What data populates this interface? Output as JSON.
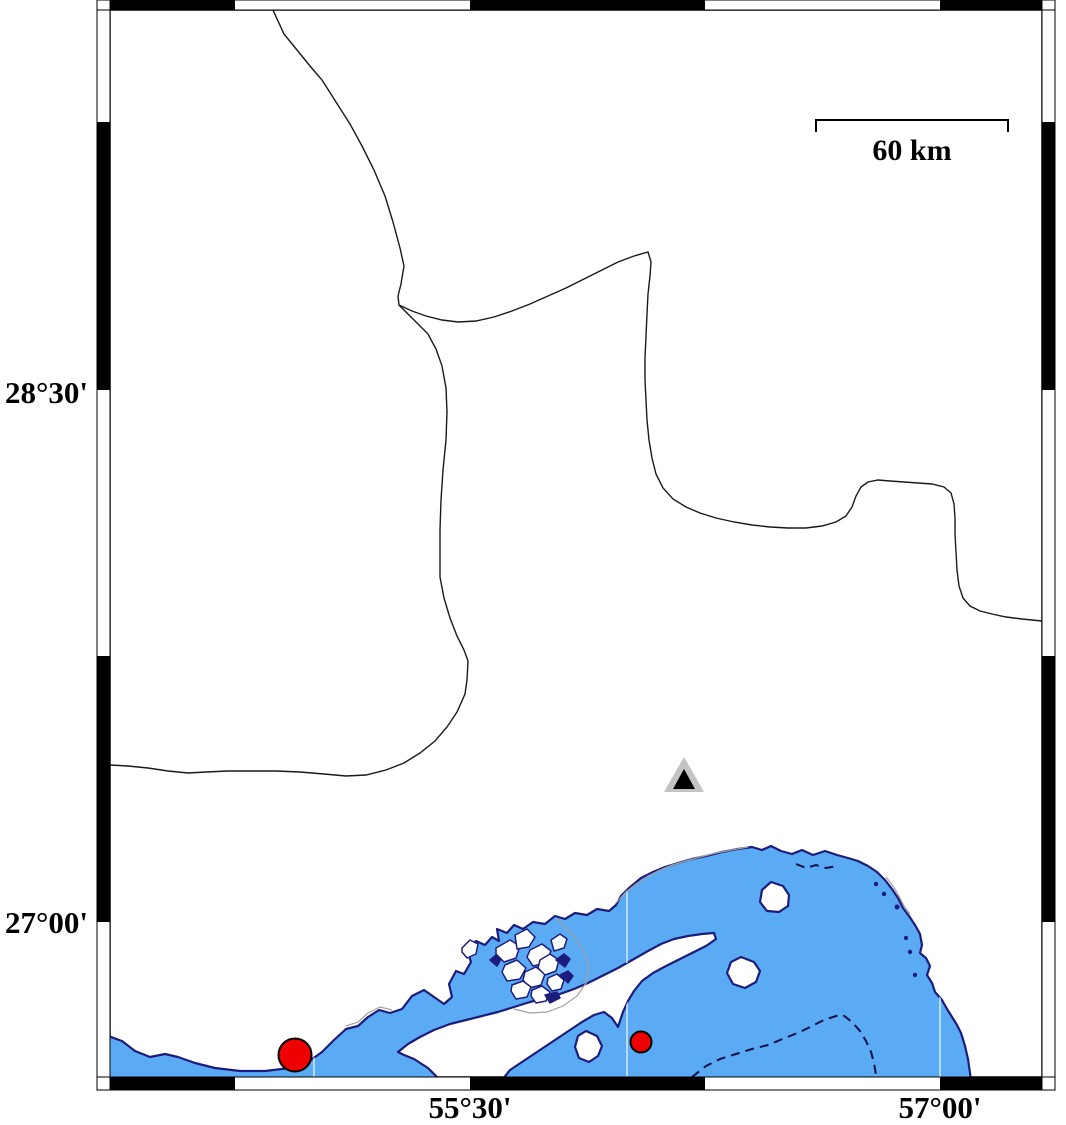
{
  "frame": {
    "lat_labels": [
      {
        "label": "28°30'"
      },
      {
        "label": "27°00'"
      }
    ],
    "lon_labels": [
      {
        "label": "55°30'"
      },
      {
        "label": "57°00'"
      }
    ]
  },
  "scalebar": {
    "label": "60 km"
  },
  "colors": {
    "water": "#5aabf4",
    "coastline": "#1c1c7c",
    "land": "#ffffff",
    "quake_fill": "#ee0000",
    "quake_stroke": "#000000",
    "station_fill": "#c3c3c3",
    "station_inner": "#000000",
    "border": "#1a1a1a",
    "contour_dash": "#10104a",
    "grid_in_water": "#cfe6fb",
    "aux_gray": "#a0a0a0",
    "frame_black": "#000000"
  },
  "markers": {
    "station": {
      "outer_points": "684,757 664,792 704,792",
      "inner_points": "684,769 673,789 695,789"
    },
    "earthquakes": [
      {
        "cx": 295,
        "cy": 1055,
        "r": 16.5
      },
      {
        "cx": 641,
        "cy": 1042,
        "r": 10.5
      }
    ]
  }
}
